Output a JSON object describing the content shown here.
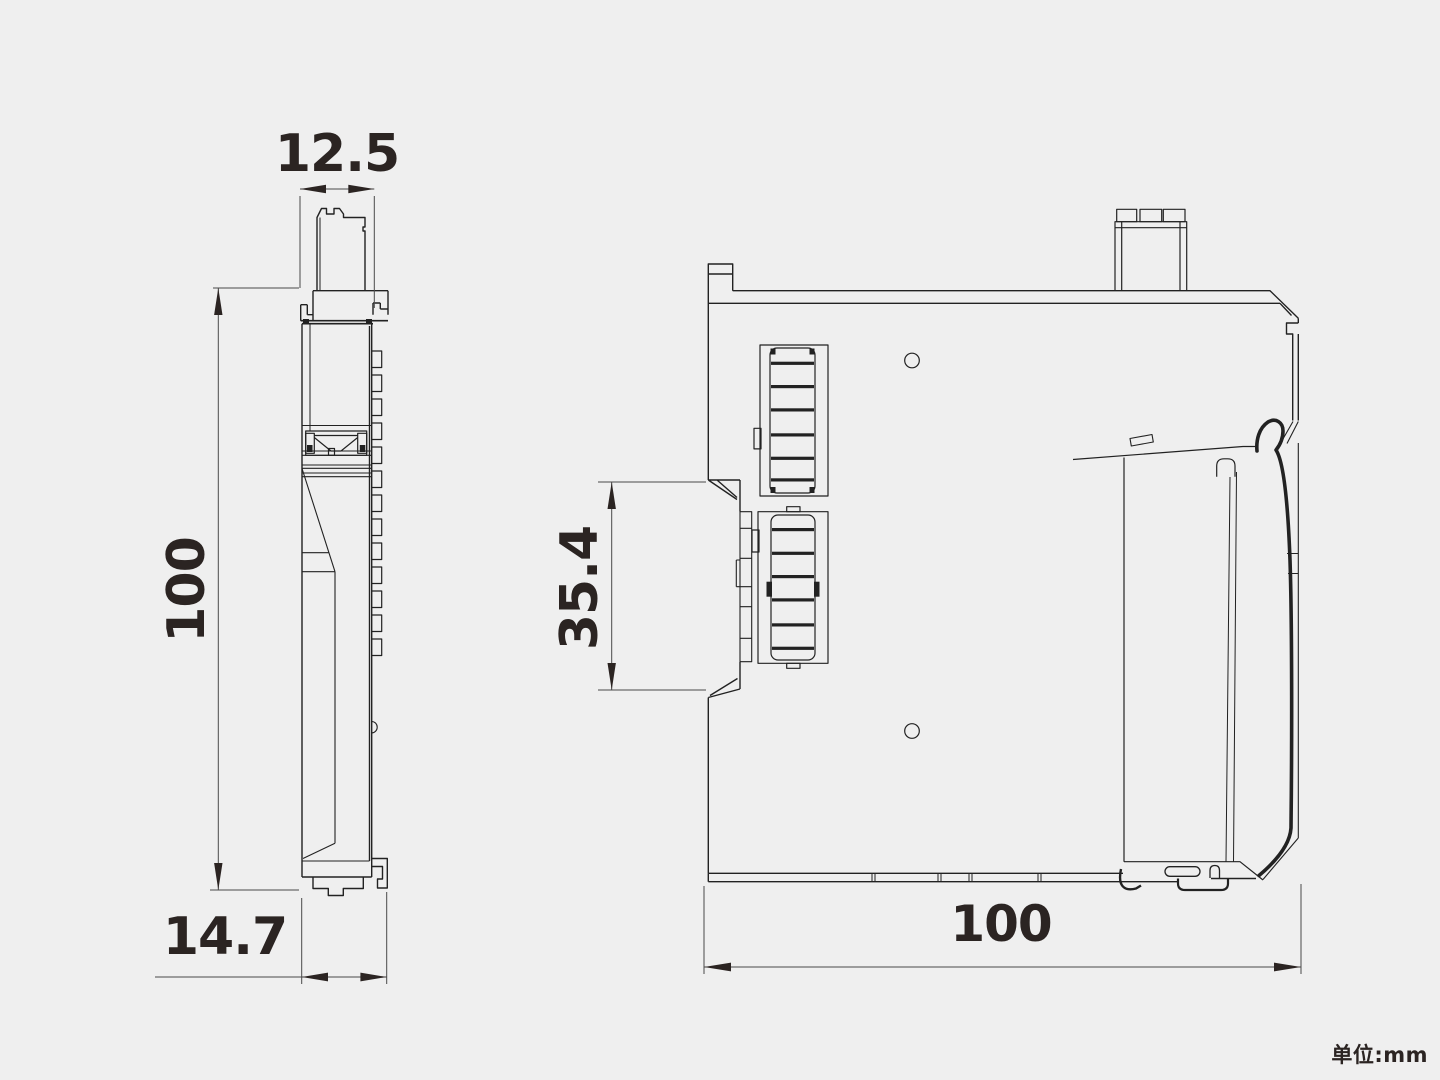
{
  "page": {
    "background_color": "#efefef"
  },
  "drawing": {
    "kind": "technical_dimension_drawing",
    "line_color": "#222222",
    "dimension_line_color": "#4a4a4a",
    "text_color": "#2b2422",
    "views": [
      {
        "name": "front-profile-view",
        "dimensions": [
          {
            "id": "top_width_mm",
            "value": "12.5"
          },
          {
            "id": "left_height_mm",
            "value": "100"
          },
          {
            "id": "bottom_depth_mm",
            "value": "14.7"
          }
        ]
      },
      {
        "name": "side-view",
        "dimensions": [
          {
            "id": "connector_height_mm",
            "value": "35.4"
          },
          {
            "id": "bottom_width_mm",
            "value": "100"
          }
        ]
      }
    ],
    "units_note": "单位:mm"
  }
}
